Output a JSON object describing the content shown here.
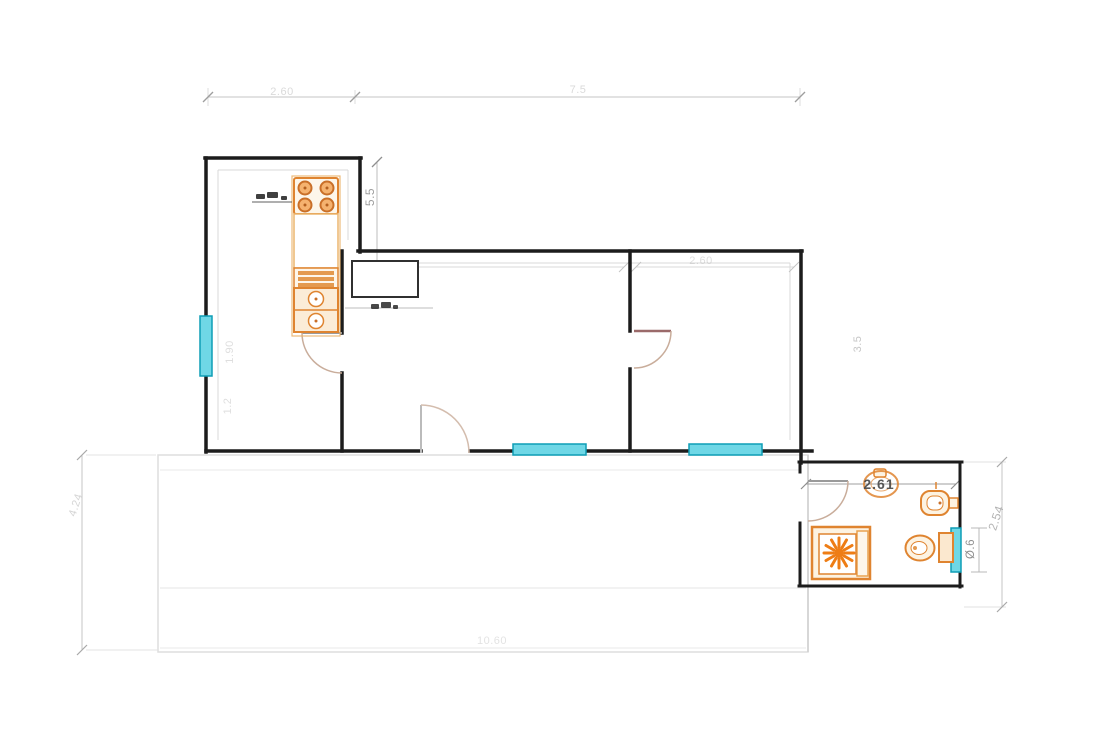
{
  "plan": {
    "type": "architectural-floor-plan",
    "dimension_labels": {
      "top_left": "2.60",
      "top_right": "7.5",
      "kitchen_height": "5.5",
      "kitchen_window_height": "1.90",
      "kitchen_wall_lower": "1.2",
      "bedroom_width": "2.60",
      "right_wall_height": "3.5",
      "bathroom_width": "2.61",
      "bathroom_window_width": "Ø.6",
      "bathroom_height": "2.54",
      "left_side_height": "4.24",
      "bottom_width": "10.60"
    },
    "colors": {
      "wall": "#1c1c1c",
      "window_fill": "#6fd7e6",
      "window_border": "#0f9db6",
      "fixture_outline": "#df8430",
      "fixture_fill": "#fdf3e2",
      "sunburst": "#ee7d15",
      "dimension_text": "#a3a3a3",
      "dark_label": "#4c4c4c"
    },
    "fixtures": [
      "stove",
      "kitchen-counter",
      "kitchen-drawers",
      "kitchen-sink",
      "shower-tray",
      "toilet",
      "washbasin",
      "bidet"
    ]
  }
}
